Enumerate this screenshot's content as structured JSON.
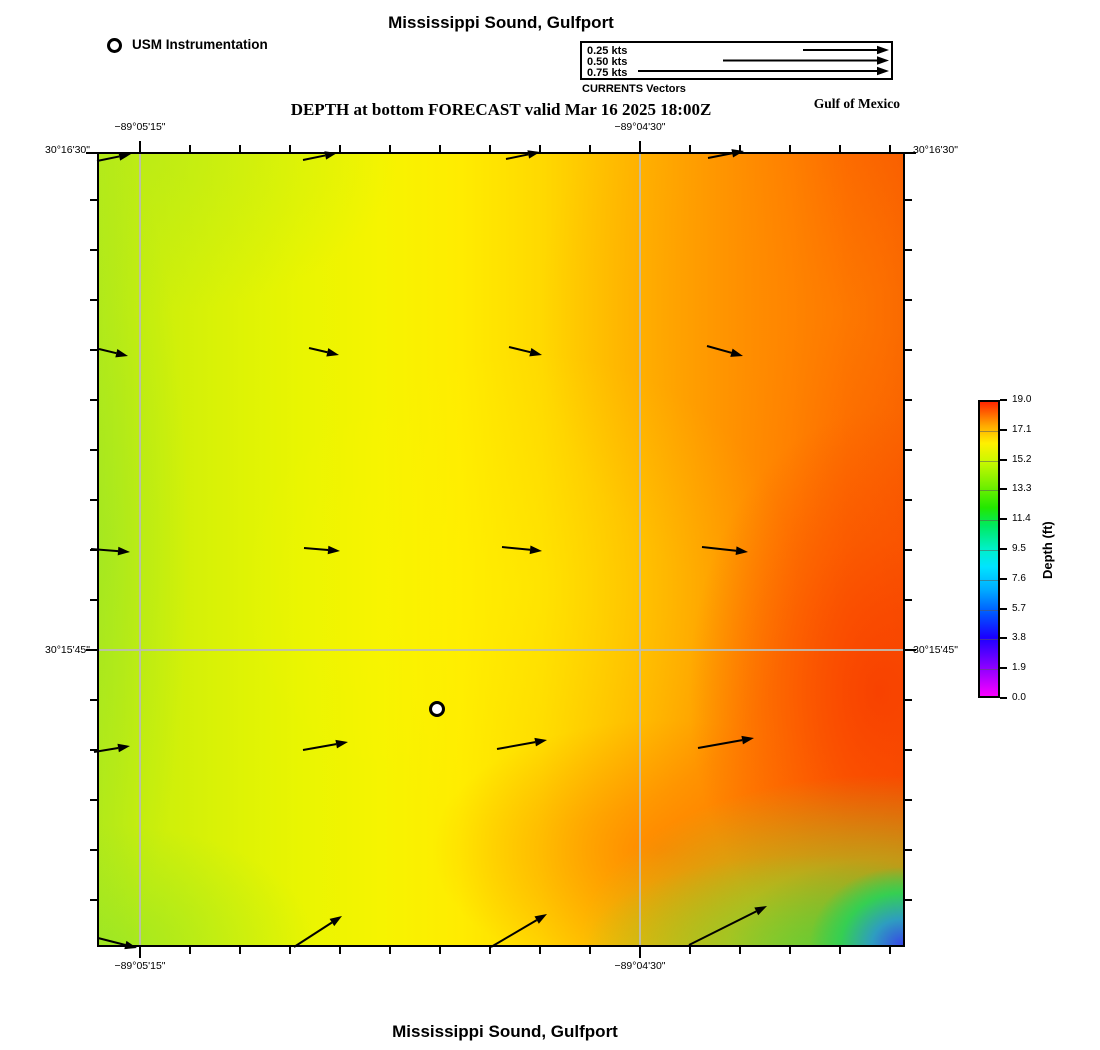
{
  "header": {
    "title": "Mississippi Sound, Gulfport",
    "station_legend_label": "USM Instrumentation",
    "currents_legend": {
      "caption": "CURRENTS Vectors",
      "items": [
        {
          "label": "0.25 kts"
        },
        {
          "label": "0.50 kts"
        },
        {
          "label": "0.75 kts"
        }
      ]
    },
    "subtitle": "DEPTH at bottom FORECAST valid Mar 16 2025 18:00Z",
    "region_label": "Gulf of Mexico"
  },
  "footer": {
    "title": "Mississippi Sound, Gulfport"
  },
  "colorbar": {
    "label": "Depth (ft)",
    "tick_labels": [
      "19.0",
      "17.1",
      "15.2",
      "13.3",
      "11.4",
      "9.5",
      "7.6",
      "5.7",
      "3.8",
      "1.9",
      "0.0"
    ]
  },
  "axes": {
    "top": [
      {
        "text": "−89°05'15\"",
        "x": 140
      },
      {
        "text": "−89°04'30\"",
        "x": 640
      }
    ],
    "bottom": [
      {
        "text": "−89°05'15\"",
        "x": 140
      },
      {
        "text": "−89°04'30\"",
        "x": 640
      }
    ],
    "left": [
      {
        "text": "30°16'30\"",
        "y": 150
      },
      {
        "text": "30°15'45\"",
        "y": 650
      }
    ],
    "right": [
      {
        "text": "30°16'30\"",
        "y": 150
      },
      {
        "text": "30°15'45\"",
        "y": 650
      }
    ]
  },
  "chart_data": {
    "type": "heatmap",
    "title": "Mississippi Sound, Gulfport",
    "subtitle": "DEPTH at bottom FORECAST valid Mar 16 2025 18:00Z",
    "region_label": "Gulf of Mexico",
    "colorbar": {
      "label": "Depth (ft)",
      "min": 0.0,
      "max": 19.0,
      "ticks": [
        19.0,
        17.1,
        15.2,
        13.3,
        11.4,
        9.5,
        7.6,
        5.7,
        3.8,
        1.9,
        0.0
      ],
      "colormap": "rainbow: magenta-blue-cyan-green-yellow-orange-red (low to high)"
    },
    "x_axis": {
      "label": "longitude",
      "annotated_gridlines": [
        "−89°05'15\"",
        "−89°04'30\""
      ]
    },
    "y_axis": {
      "label": "latitude",
      "annotated_gridlines": [
        "30°16'30\"",
        "30°15'45\""
      ]
    },
    "depth_field_ft_approx": {
      "description": "approximate depth (ft) read from colors on a 4-lon x 5-lat sample grid, west to east / north to south",
      "rows": [
        [
          14.3,
          14.9,
          15.6,
          16.6
        ],
        [
          14.2,
          14.8,
          15.7,
          17.0
        ],
        [
          14.1,
          14.7,
          15.6,
          17.4
        ],
        [
          14.0,
          14.6,
          15.9,
          17.7
        ],
        [
          13.8,
          14.5,
          15.4,
          12.5
        ]
      ],
      "extremes": {
        "max_ft": 19.0,
        "max_location": "east edge, mid-to-south (deep red)",
        "min_ft": 4.0,
        "min_location": "extreme southeast corner (blue patch)"
      }
    },
    "current_vectors": {
      "caption": "CURRENTS Vectors",
      "legend_speeds_kts": [
        0.25,
        0.5,
        0.75
      ],
      "grid": "4 columns x 5 rows of arrows",
      "directions": "eastward in northern four rows (slight tilts), northeastward along the southern row",
      "approx_speed_kts_rows": [
        [
          0.1,
          0.1,
          0.1,
          0.11
        ],
        [
          0.09,
          0.09,
          0.1,
          0.11
        ],
        [
          0.11,
          0.1,
          0.12,
          0.13
        ],
        [
          0.11,
          0.13,
          0.15,
          0.16
        ],
        [
          0.12,
          0.17,
          0.19,
          0.25
        ]
      ]
    },
    "station": {
      "name": "USM Instrumentation",
      "marker": "white circle with black ring, located south-center of map"
    }
  },
  "render": {
    "map": {
      "x": 97,
      "y": 152,
      "w": 808,
      "h": 795
    },
    "grid_v_px": [
      140,
      640
    ],
    "grid_h_px": [
      650
    ],
    "ticks": {
      "x_start": 140,
      "x_step": 50,
      "x_end": 890,
      "y_start": 200,
      "y_step": 50,
      "y_end": 900,
      "len": 7,
      "annot_len": 11,
      "annot_x": [
        140,
        640
      ],
      "annot_y": [
        153,
        650
      ]
    },
    "arrows": [
      [
        97,
        161,
        131,
        154
      ],
      [
        303,
        160,
        337,
        153
      ],
      [
        506,
        159,
        540,
        152
      ],
      [
        708,
        158,
        744,
        151
      ],
      [
        99,
        349,
        128,
        356
      ],
      [
        309,
        348,
        339,
        355
      ],
      [
        509,
        347,
        542,
        355
      ],
      [
        707,
        346,
        743,
        356
      ],
      [
        91,
        549,
        130,
        552
      ],
      [
        304,
        548,
        340,
        551
      ],
      [
        502,
        547,
        542,
        551
      ],
      [
        702,
        547,
        748,
        552
      ],
      [
        94,
        752,
        130,
        746
      ],
      [
        303,
        750,
        348,
        742
      ],
      [
        497,
        749,
        547,
        740
      ],
      [
        698,
        748,
        754,
        738
      ],
      [
        98,
        938,
        137,
        948
      ],
      [
        294,
        947,
        342,
        916
      ],
      [
        491,
        947,
        547,
        914
      ],
      [
        689,
        945,
        767,
        906
      ]
    ],
    "legend_arrows": [
      [
        803,
        50,
        889,
        50
      ],
      [
        723,
        60.5,
        889,
        60.5
      ],
      [
        638,
        71,
        889,
        71
      ]
    ],
    "station_px": {
      "x": 437,
      "y": 709,
      "r": 6.5
    },
    "colorbar_box": {
      "x": 978,
      "y": 400,
      "w": 22,
      "h": 298
    }
  }
}
